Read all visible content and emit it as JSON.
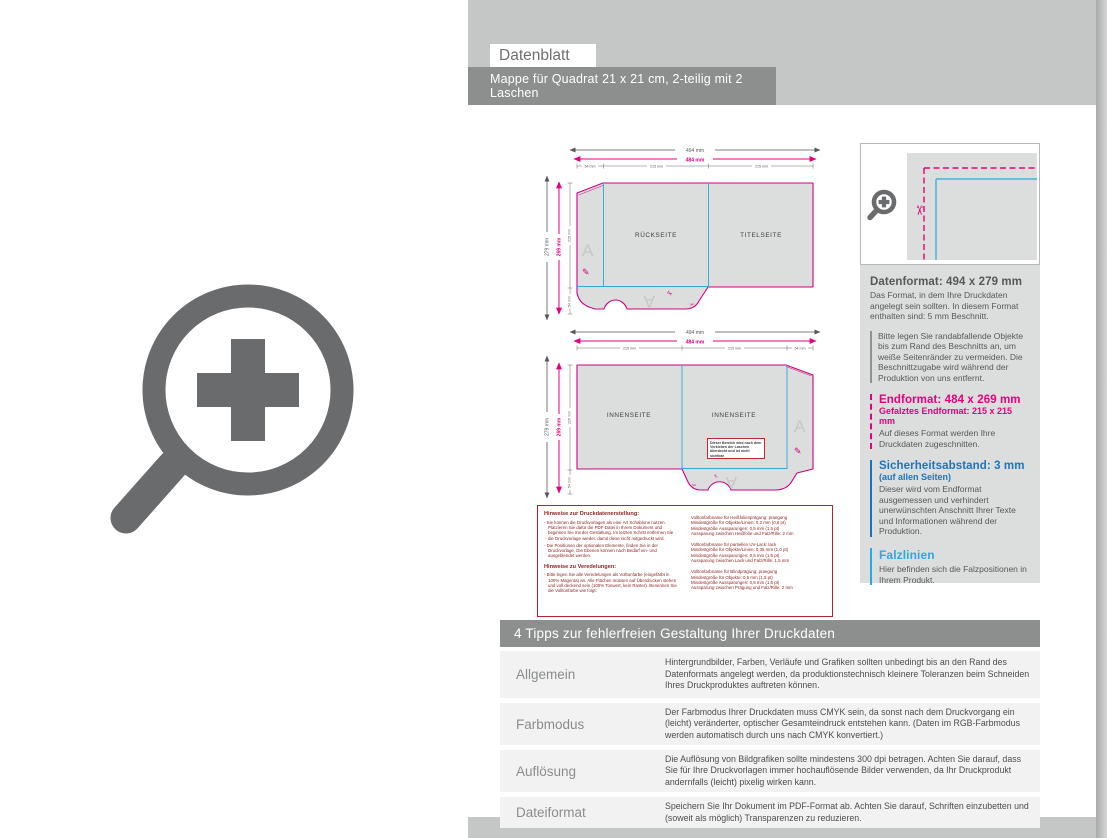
{
  "colors": {
    "band_gray": "#c5c6c6",
    "bar_gray": "#8d8e8e",
    "icon_gray": "#6a6b6d",
    "magenta": "#e6007e",
    "fold_blue": "#2ba8e0",
    "info_blue": "#1c75bc",
    "cyan": "#29abe2",
    "note_red": "#8f2420"
  },
  "header": {
    "sheet_title": "Datenblatt",
    "product_title": "Mappe für Quadrat 21 x 21 cm, 2-teilig mit 2 Laschen",
    "product_subtitle": "4/0farbig (Außenseite bedruckt) mit Veredelung, 1 mm Füllhöhe"
  },
  "diagrams": {
    "dims": {
      "width_outer": "494 mm",
      "width_inner": "484 mm",
      "height_outer": "279 mm",
      "height_inner": "269 mm",
      "segment_small": "54 mm",
      "segment_panel": "215 mm"
    },
    "outside": {
      "panel_left": "RÜCKSEITE",
      "panel_right": "TITELSEITE",
      "watermark": "A"
    },
    "inside": {
      "panel_left": "INNENSEITE",
      "panel_right": "INNENSEITE",
      "watermark": "A",
      "warning_note": "Dieser Bereich wird nach dem Verkleben der Laschen überdeckt und ist nicht sichtbar"
    }
  },
  "production_notes": {
    "col1": {
      "title1": "Hinweise zur Druckdatenerstellung:",
      "item1": "- Sie können die Druckvorlagen als eine Art Schablone nutzen. Platzieren Sie dafür die PDF-Datei in Ihrem Dokument und beginnen Sie mit der Gestaltung. Im letzten Schritt entfernen Sie die Druckvorlage wieder, damit diese nicht mitgedruckt wird.",
      "item2": "- Die Positionen der optionalen Elemente, finden Sie in der Druckvorlage. Die Ebenen können nach Bedarf ein- und ausgeblendet werden.",
      "title2": "Hinweise zu Veredelungen:",
      "item3": "- Bitte legen Sie alle Veredelungen als Volltonfarbe (eingefärbt in 100% Magenta) an. Alle Flächen müssen auf Überdrucken stehen und voll deckend sein (100% Tonwert, kein Raster). Benennen Sie die Volltonfarbe wie folgt:"
    },
    "col2": {
      "block1": "Volltonfarbname für Heißfolienprägung: praegung\nMindestgröße für Objekte/Linien: 0,2 mm (0,6 pt)\nMindestgröße Aussparungen: 0,5 mm (1,5 pt)\nAussparung zwischen Heißfolie und Falz/Rille: 2 mm",
      "block2": "Volltonfarbname für partiellen UV-Lack: lack\nMindestgröße für Objekte/Linien: 0,35 mm (1,0 pt)\nMindestgröße Aussparungen: 0,5 mm (1,5 pt)\nAussparung zwischen Lack und Falz/Rille: 1,5 mm",
      "block3": "Volltonfarbname für Blindprägung: praegung\nMindestgröße für Objekte: 0,5 mm (1,5 pt)\nMindestgröße Aussparungen: 0,5 mm (1,5 pt)\nAussparung zwischen Prägung und Falz/Rille: 2 mm"
    }
  },
  "sidebar": {
    "datenformat": {
      "heading": "Datenformat: 494 x 279 mm",
      "body": "Das Format, in dem Ihre Druckdaten angelegt sein sollten. In diesem Format enthalten sind: 5 mm Beschnitt.",
      "tip": "Bitte legen Sie randabfallende Objekte bis zum Rand des Beschnitts an, um weiße Seitenränder zu vermeiden. Die Beschnittzugabe wird während der Produktion von uns entfernt."
    },
    "endformat": {
      "heading": "Endformat: 484 x 269 mm",
      "subheading": "Gefalztes Endformat: 215 x 215 mm",
      "body": "Auf dieses Format werden Ihre Druckdaten zugeschnitten."
    },
    "sicherheitsabstand": {
      "heading": "Sicherheitsabstand: 3 mm",
      "subheading": "(auf allen Seiten)",
      "body": "Dieser wird vom Endformat ausgemessen und verhindert unerwünschten Anschnitt Ihrer Texte und Informationen während der Produktion."
    },
    "falzlinien": {
      "heading": "Falzlinien",
      "body": "Hier befinden sich die Falzpositionen in Ihrem Produkt."
    }
  },
  "tips": {
    "header": "4 Tipps zur fehlerfreien Gestaltung Ihrer Druckdaten",
    "rows": [
      {
        "label": "Allgemein",
        "text": "Hintergrundbilder, Farben, Verläufe und Grafiken sollten unbedingt bis an den Rand des Datenformats angelegt werden, da produktionstechnisch kleinere Toleranzen beim Schneiden Ihres Druckproduktes auftreten können."
      },
      {
        "label": "Farbmodus",
        "text": "Der Farbmodus Ihrer Druckdaten muss CMYK sein, da sonst nach dem Druckvorgang ein (leicht) veränderter, optischer Gesamteindruck entstehen kann. (Daten im RGB-Farbmodus werden automatisch durch uns nach CMYK konvertiert.)"
      },
      {
        "label": "Auflösung",
        "text": "Die Auflösung von Bildgrafiken sollte mindestens 300 dpi betragen. Achten Sie darauf, dass Sie für Ihre Druckvorlagen immer hochauflösende Bilder verwenden, da Ihr Druckprodukt andernfalls (leicht) pixelig wirken kann."
      },
      {
        "label": "Dateiformat",
        "text": "Speichern Sie Ihr Dokument im PDF-Format ab. Achten Sie darauf, Schriften einzubetten und (soweit als möglich) Transparenzen zu reduzieren."
      }
    ]
  }
}
